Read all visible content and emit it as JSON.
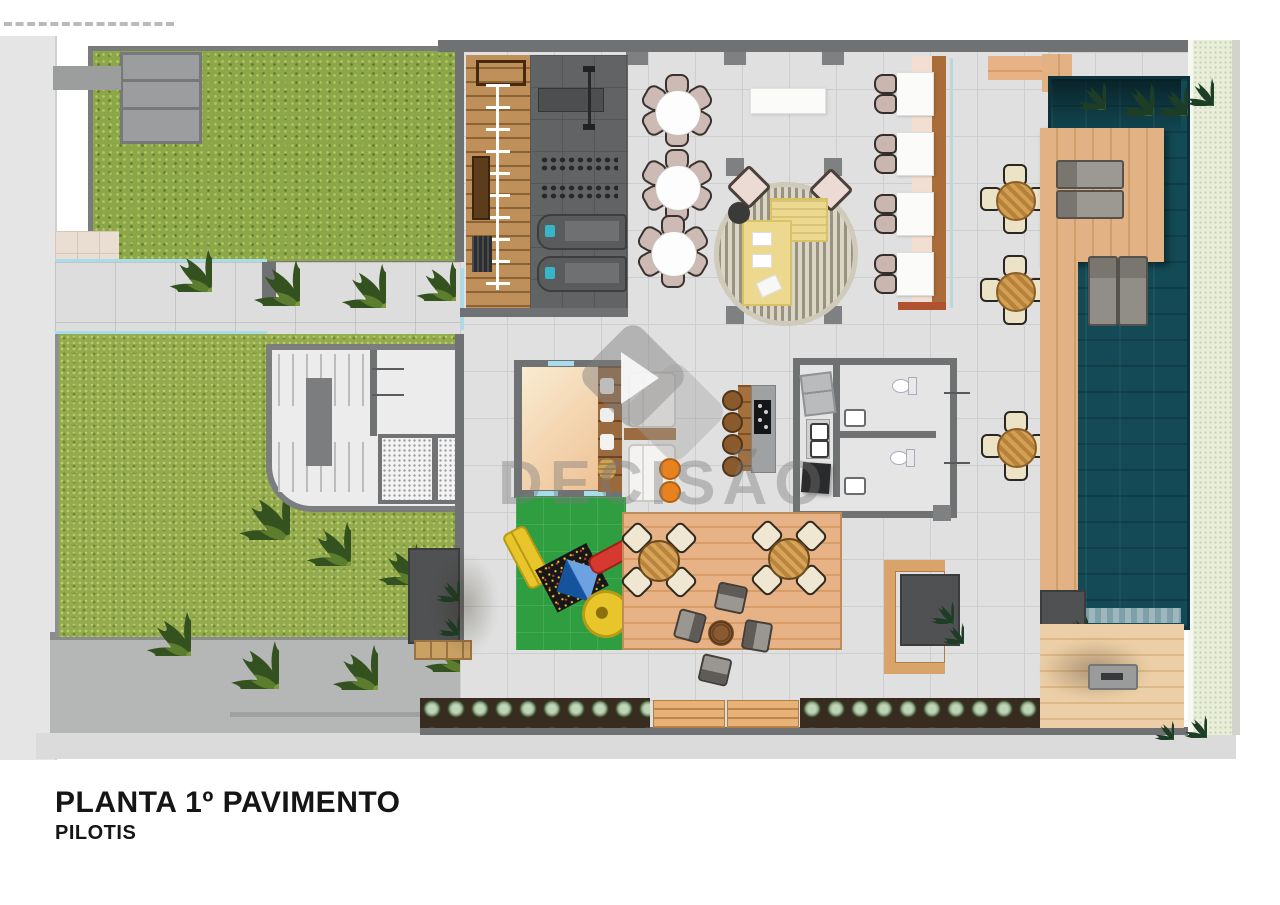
{
  "document": {
    "kind": "architectural floor plan render, top view",
    "heading": "PLANTA 1º PAVIMENTO",
    "subheading": "PILOTIS"
  },
  "watermark": {
    "text": "DECISÃO",
    "logo": "play-triangle-double-diamond"
  },
  "palette": {
    "grass": "#8ba74a",
    "pool_water": "#134a55",
    "deck_wood_light": "#e2b184",
    "deck_wood_warm": "#d89c67",
    "wood_dark": "#a5703c",
    "tile_floor": "#dfe0df",
    "gym_floor": "#616365",
    "wall_gray": "#6f7172",
    "playground_green": "#2f9e41",
    "pale_green_border_strip": "#e9eeda",
    "sidewalk": "#e4e5e4",
    "driveway": "#b5b6b6",
    "glass_accent": "#a7dcea",
    "pouf_orange": "#e8821e",
    "sofa_yellow": "#ecd98f",
    "slide_red": "#d6392f",
    "play_blue": "#1d6fd2",
    "play_yellow": "#e8c52b"
  },
  "icons": [
    "palm-tree",
    "tropical-plant",
    "shrub-planter",
    "treadmill",
    "bench-press",
    "dumbbell-rack",
    "agility-ladder",
    "pull-up-bar",
    "dining-table-6-chairs",
    "buffet-table",
    "round-rug",
    "l-sofa",
    "armchair",
    "column",
    "co-working-table",
    "banquette",
    "kitchen-island",
    "bar-stool",
    "cooktop",
    "fridge",
    "double-sink",
    "toilet",
    "washbasin",
    "kids-room-shelves",
    "playground-structure",
    "slide",
    "deck-dining-table",
    "fire-pit-lounge-chairs",
    "coffee-table",
    "c-shaped-bench",
    "sun-lounger",
    "in-pool-lounger",
    "swimming-pool",
    "fire-table",
    "garden-bench",
    "stairs",
    "elevator"
  ]
}
